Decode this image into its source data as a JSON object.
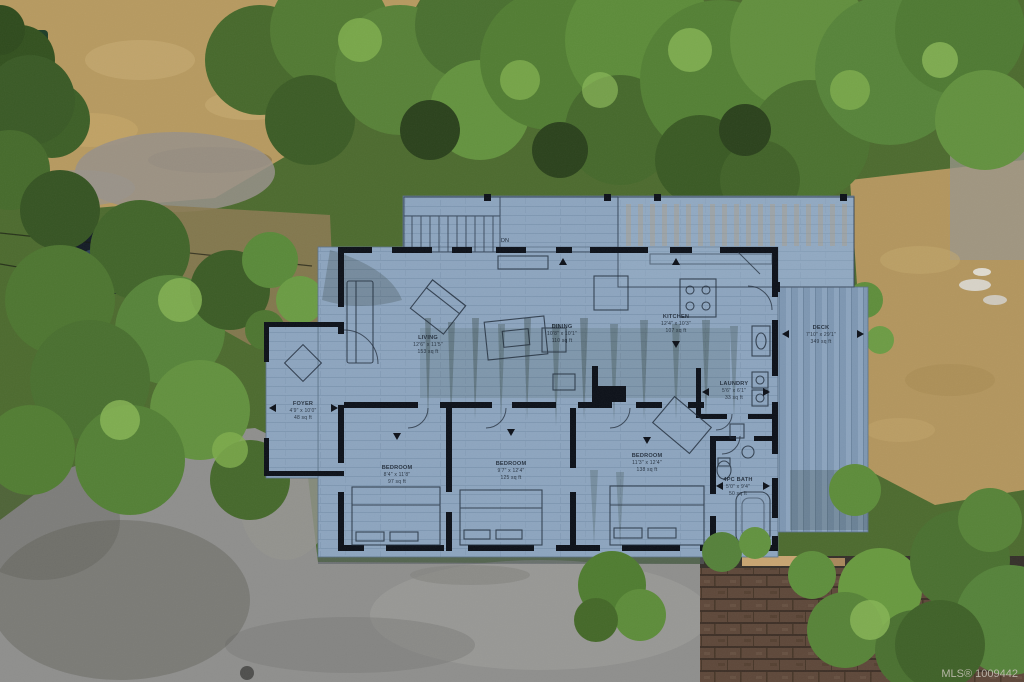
{
  "photo": {
    "description": "aerial-drone-view-house-with-floor-plan-overlay",
    "watermark": {
      "mls_label": "MLS® 1009442"
    }
  },
  "floor_plan": {
    "stair_label": "DN",
    "rooms": [
      {
        "name": "LIVING",
        "dims": "12'6\" x 11'5\"",
        "area": "153 sq ft"
      },
      {
        "name": "DINING",
        "dims": "10'8\" x 10'1\"",
        "area": "110 sq ft"
      },
      {
        "name": "KITCHEN",
        "dims": "12'4\" x 10'3\"",
        "area": "107 sq ft"
      },
      {
        "name": "DECK",
        "dims": "7'10\" x 29'1\"",
        "area": "349 sq ft"
      },
      {
        "name": "LAUNDRY",
        "dims": "5'6\" x 6'1\"",
        "area": "33 sq ft"
      },
      {
        "name": "FOYER",
        "dims": "4'9\" x 10'0\"",
        "area": "48 sq ft"
      },
      {
        "name": "BEDROOM",
        "dims": "8'4\" x 11'8\"",
        "area": "97 sq ft"
      },
      {
        "name": "BEDROOM",
        "dims": "9'7\" x 12'4\"",
        "area": "125 sq ft"
      },
      {
        "name": "BEDROOM",
        "dims": "11'3\" x 12'4\"",
        "area": "138 sq ft"
      },
      {
        "name": "4PC BATH",
        "dims": "5'0\" x 9'4\"",
        "area": "50 sq ft"
      }
    ]
  },
  "colors": {
    "plan_overlay": "#8da5bf",
    "plan_walls": "#0d1119",
    "deck_boards": "#7e97b2",
    "asphalt": "#8f8f8d",
    "dry_grass": "#b79a60",
    "tree_green": "#4d6b2f",
    "garage_shingles": "#5e483a",
    "mls_text": "#c9c4ba"
  }
}
